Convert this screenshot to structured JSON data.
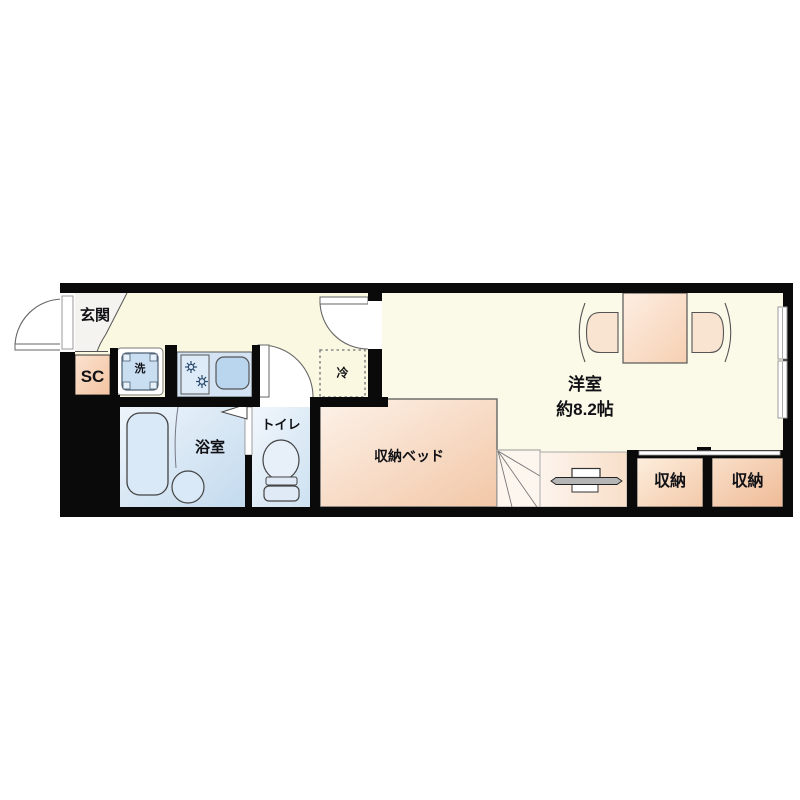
{
  "page": {
    "type": "apartment-floor-plan"
  },
  "rooms": {
    "entrance": {
      "label": "玄関"
    },
    "shoe_closet": {
      "label": "SC"
    },
    "washing_machine": {
      "label": "洗"
    },
    "refrigerator": {
      "label": "冷"
    },
    "bathroom": {
      "label": "浴室"
    },
    "toilet": {
      "label": "トイレ"
    },
    "storage_bed": {
      "label": "収納ベッド"
    },
    "western_room": {
      "label": "洋室",
      "size": "約8.2帖"
    },
    "storage_1": {
      "label": "収納"
    },
    "storage_2": {
      "label": "収納"
    }
  },
  "colors": {
    "wall": "#0a0a0a",
    "floor_cream": "#fbf9e4",
    "wet_area_blue": "#cfe2f3",
    "furniture_peach": "#f4cbab",
    "entrance_gray": "#f4f3ef",
    "text": "#121216"
  }
}
